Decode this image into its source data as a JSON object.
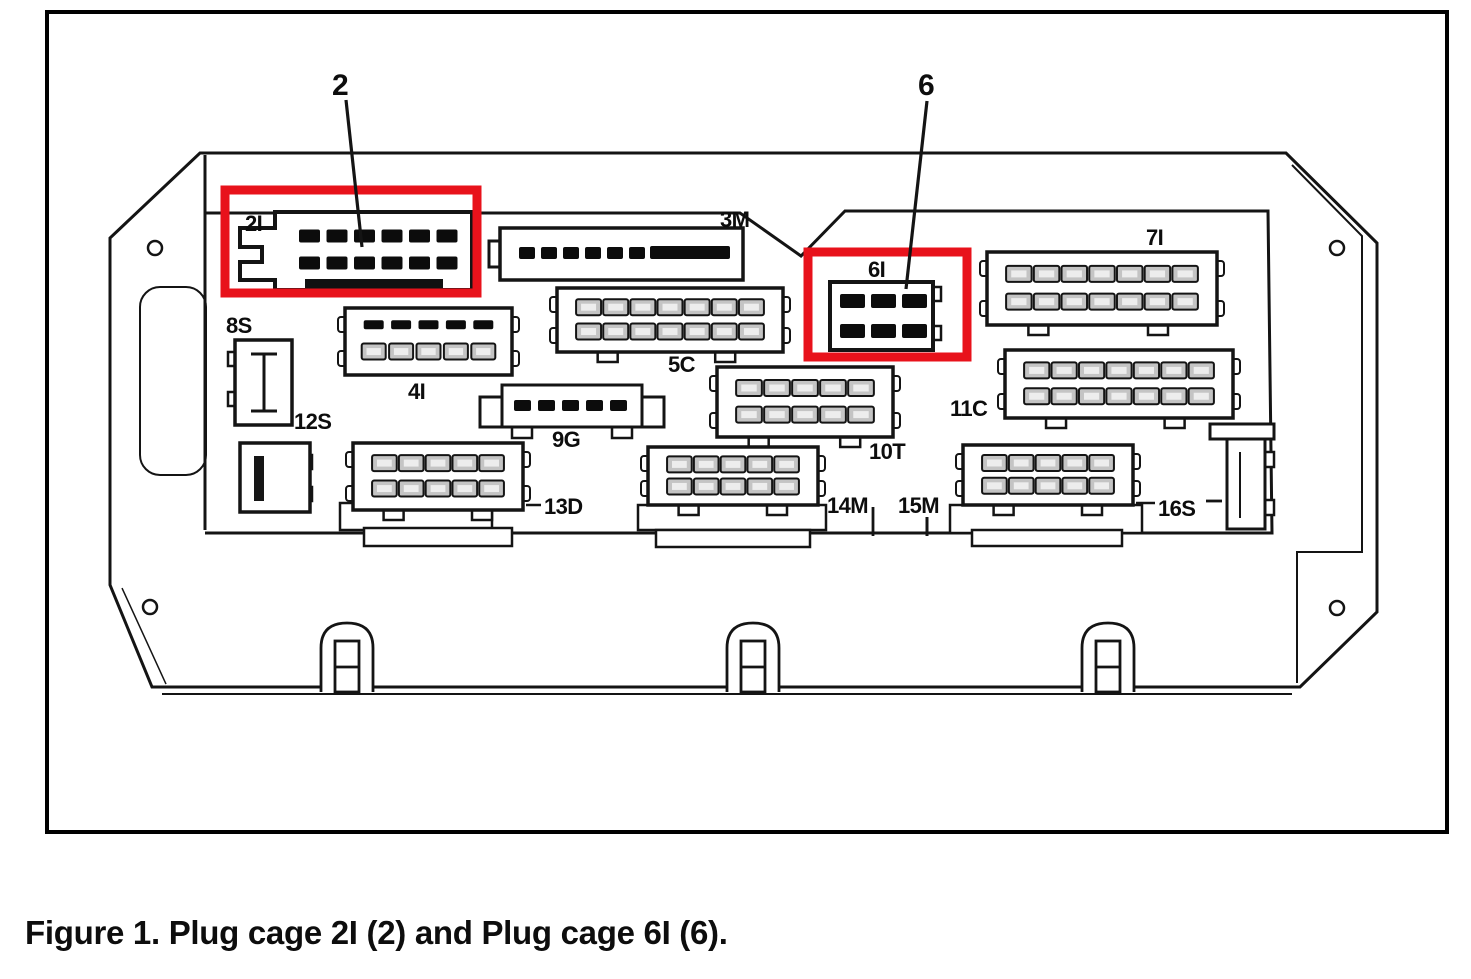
{
  "figure": {
    "caption": "Figure 1. Plug cage 2I (2) and Plug cage 6I (6).",
    "highlight_color": "#e8121b",
    "line_color": "#141414",
    "callouts": [
      {
        "text": "2",
        "x": 332,
        "y": 95,
        "leader": [
          346,
          100,
          362,
          247
        ]
      },
      {
        "text": "6",
        "x": 918,
        "y": 95,
        "leader": [
          927,
          101,
          906,
          289
        ]
      }
    ],
    "highlights": [
      {
        "target": "2I",
        "x": 225,
        "y": 190,
        "w": 252,
        "h": 103
      },
      {
        "target": "6I",
        "x": 808,
        "y": 252,
        "w": 159,
        "h": 105
      }
    ],
    "connectors": [
      {
        "id": "2I",
        "label": "2I",
        "label_x": 245,
        "label_y": 231,
        "shape": "plug2I",
        "x": 262,
        "y": 212,
        "w": 210,
        "h": 78,
        "rows": 2,
        "pins": 6,
        "pin_style": "solid"
      },
      {
        "id": "3M",
        "label": "3M",
        "label_x": 720,
        "label_y": 227,
        "shape": "plug3M",
        "x": 500,
        "y": 228,
        "w": 243,
        "h": 52,
        "rows": 1,
        "pins": 7,
        "pin_style": "solid"
      },
      {
        "id": "4I",
        "label": "4I",
        "label_x": 408,
        "label_y": 399,
        "shape": "box",
        "x": 345,
        "y": 308,
        "w": 167,
        "h": 67,
        "rows": 2,
        "pins": 5,
        "pin_style": "mixed"
      },
      {
        "id": "5C",
        "label": "5C",
        "label_x": 668,
        "label_y": 372,
        "shape": "box",
        "x": 557,
        "y": 288,
        "w": 226,
        "h": 64,
        "rows": 2,
        "pins": 7,
        "pin_style": "socket"
      },
      {
        "id": "6I",
        "label": "6I",
        "label_x": 868,
        "label_y": 277,
        "shape": "box6I",
        "x": 830,
        "y": 282,
        "w": 103,
        "h": 68,
        "rows": 2,
        "pins": 3,
        "pin_style": "solid"
      },
      {
        "id": "7I",
        "label": "7I",
        "label_x": 1146,
        "label_y": 245,
        "shape": "box",
        "x": 987,
        "y": 252,
        "w": 230,
        "h": 73,
        "rows": 2,
        "pins": 7,
        "pin_style": "socket"
      },
      {
        "id": "8S",
        "label": "8S",
        "label_x": 226,
        "label_y": 333,
        "shape": "bracketL",
        "x": 235,
        "y": 340,
        "w": 57,
        "h": 85,
        "rows": 0,
        "pins": 0,
        "pin_style": "none"
      },
      {
        "id": "9G",
        "label": "9G",
        "label_x": 552,
        "label_y": 447,
        "shape": "plug9G",
        "x": 480,
        "y": 385,
        "w": 183,
        "h": 42,
        "rows": 1,
        "pins": 5,
        "pin_style": "solid"
      },
      {
        "id": "10T",
        "label": "10T",
        "label_x": 869,
        "label_y": 459,
        "shape": "box",
        "x": 717,
        "y": 367,
        "w": 176,
        "h": 70,
        "rows": 2,
        "pins": 5,
        "pin_style": "socket"
      },
      {
        "id": "11C",
        "label": "11C",
        "label_x": 950,
        "label_y": 416,
        "shape": "box",
        "x": 1005,
        "y": 350,
        "w": 228,
        "h": 68,
        "rows": 2,
        "pins": 7,
        "pin_style": "socket"
      },
      {
        "id": "12S",
        "label": "12S",
        "label_x": 294,
        "label_y": 429,
        "shape": "bracketR",
        "x": 240,
        "y": 443,
        "w": 70,
        "h": 69,
        "rows": 0,
        "pins": 0,
        "pin_style": "none"
      },
      {
        "id": "13D",
        "label": "13D",
        "label_x": 544,
        "label_y": 514,
        "shape": "box",
        "x": 353,
        "y": 443,
        "w": 170,
        "h": 67,
        "rows": 2,
        "pins": 5,
        "pin_style": "socket",
        "leader": [
          526,
          505,
          541,
          505
        ]
      },
      {
        "id": "14M",
        "label": "14M",
        "label_x": 827,
        "label_y": 513,
        "shape": "box",
        "x": 648,
        "y": 447,
        "w": 170,
        "h": 58,
        "rows": 2,
        "pins": 5,
        "pin_style": "socket"
      },
      {
        "id": "15M",
        "label": "15M",
        "label_x": 898,
        "label_y": 513,
        "shape": "labelOnly",
        "tick": [
          927,
          517,
          927,
          536
        ]
      },
      {
        "id": "16S",
        "label": "16S",
        "label_x": 1158,
        "label_y": 516,
        "shape": "box",
        "x": 963,
        "y": 445,
        "w": 170,
        "h": 60,
        "rows": 2,
        "pins": 5,
        "pin_style": "socket",
        "leader": [
          1136,
          503,
          1155,
          503
        ]
      }
    ]
  }
}
